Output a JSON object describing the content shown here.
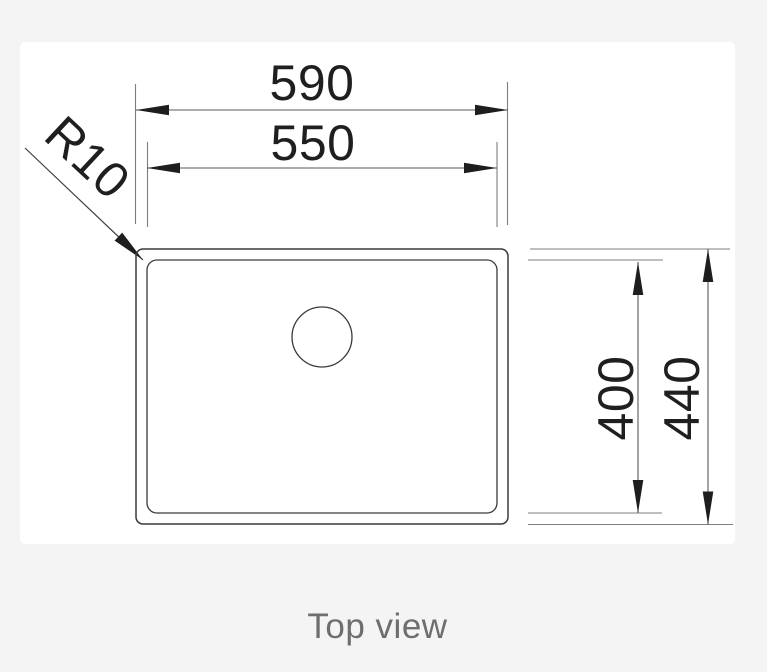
{
  "drawing": {
    "type": "sink-top-view-technical-drawing",
    "dimensions": {
      "outer_width": "590",
      "inner_width": "550",
      "inner_depth": "400",
      "outer_depth": "440",
      "corner_radius": "R10"
    },
    "caption": "Top view"
  },
  "colors": {
    "background": "#f4f4f5",
    "panel": "#ffffff",
    "outline": "#3a3a3a",
    "dimension_line": "#5a5a5a",
    "extension_line": "#7f7f7f",
    "arrowhead": "#1e1e1e",
    "dimension_text": "#1f1f1f",
    "caption_text": "#6e6e6e"
  }
}
